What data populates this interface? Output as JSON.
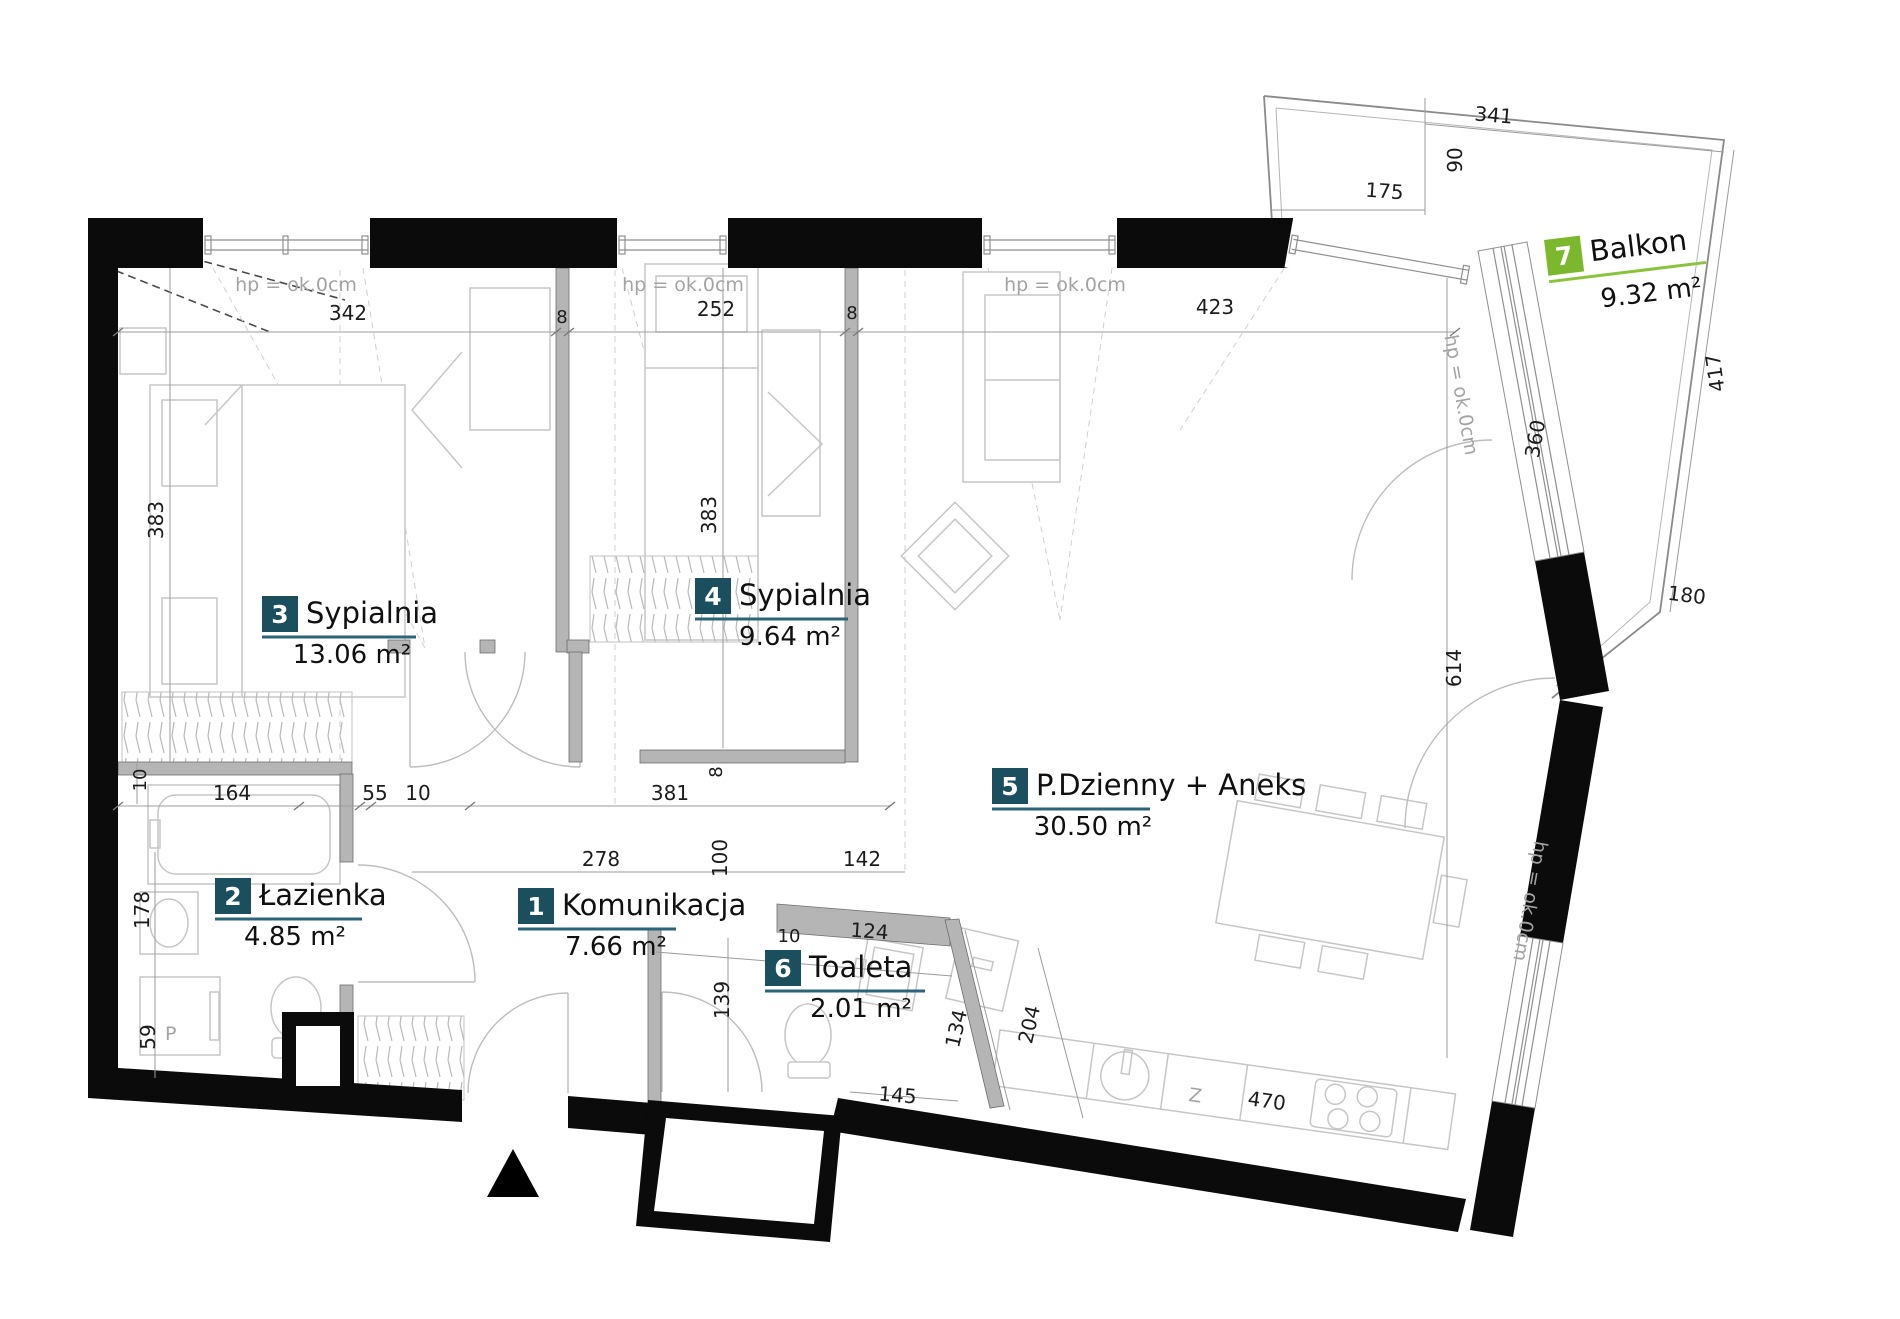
{
  "rooms": [
    {
      "number": "1",
      "name": "Komunikacja",
      "area_label": "7.66 m²"
    },
    {
      "number": "2",
      "name": "Łazienka",
      "area_label": "4.85 m²"
    },
    {
      "number": "3",
      "name": "Sypialnia",
      "area_label": "13.06 m²"
    },
    {
      "number": "4",
      "name": "Sypialnia",
      "area_label": "9.64 m²"
    },
    {
      "number": "5",
      "name": "P.Dzienny + Aneks",
      "area_label": "30.50 m²"
    },
    {
      "number": "6",
      "name": "Toaleta",
      "area_label": "2.01 m²"
    },
    {
      "number": "7",
      "name": "Balkon",
      "area_label": "9.32 m²"
    }
  ],
  "labels": {
    "window_sill": "hp = ok.0cm",
    "washer": "P",
    "sink": "Z"
  },
  "dims": {
    "room3_width": "342",
    "partition_a": "8",
    "room4_width": "252",
    "partition_b": "8",
    "living_width": "423",
    "balcony_341": "341",
    "balcony_175": "175",
    "balcony_90": "90",
    "balcony_360": "360",
    "balcony_417": "417",
    "balcony_180": "180",
    "room3_depth": "383",
    "room4_depth": "383",
    "left_wall_10": "10",
    "bath_164": "164",
    "bath_55": "55",
    "bath_10": "10",
    "bath_178": "178",
    "bath_59": "59",
    "hall_381": "381",
    "hall_8": "8",
    "hall_278": "278",
    "hall_100": "100",
    "hall_142": "142",
    "hall_139": "139",
    "toilet_10": "10",
    "toilet_124": "124",
    "toilet_134": "134",
    "toilet_145": "145",
    "kitchen_204": "204",
    "kitchen_470": "470",
    "living_614": "614"
  },
  "colors": {
    "badge": "#1b4f5e",
    "underline": "#2b6577",
    "balcony_badge": "#7cb82e",
    "balcony_underline": "#8bc43c",
    "wall": "#0b0b0b"
  }
}
